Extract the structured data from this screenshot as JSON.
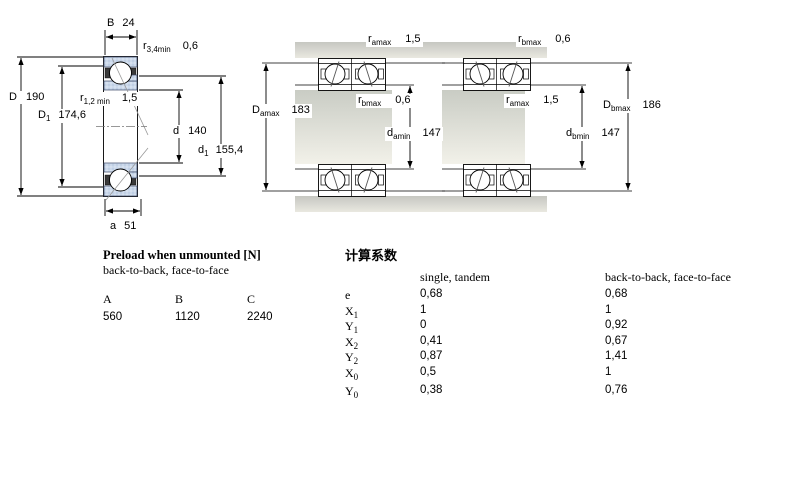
{
  "colors": {
    "ring_fill": "#ccd9eb",
    "ring_dot": "#adc0da",
    "metal_dark": "#c6c7c1",
    "metal_light": "#e9e8e0",
    "line": "#000000"
  },
  "left_view": {
    "dims": {
      "B": {
        "base": "B",
        "sub": "",
        "value": "24"
      },
      "r34": {
        "base": "r",
        "sub": "3,4min",
        "value": "0,6"
      },
      "D": {
        "base": "D",
        "sub": "",
        "value": "190"
      },
      "D1": {
        "base": "D",
        "sub": "1",
        "value": "174,6"
      },
      "r12": {
        "base": "r",
        "sub": "1,2 min",
        "value": "1,5"
      },
      "d": {
        "base": "d",
        "sub": "",
        "value": "140"
      },
      "d1": {
        "base": "d",
        "sub": "1",
        "value": "155,4"
      },
      "a": {
        "base": "a",
        "sub": "",
        "value": "51"
      }
    }
  },
  "pair_views": {
    "left": {
      "r_top": {
        "base": "r",
        "sub": "amax",
        "value": "1,5"
      },
      "r_mid": {
        "base": "r",
        "sub": "bmax",
        "value": "0,6"
      },
      "D_dim": {
        "base": "D",
        "sub": "amax",
        "value": "183"
      },
      "d_dim": {
        "base": "d",
        "sub": "amin",
        "value": "147"
      }
    },
    "right": {
      "r_top": {
        "base": "r",
        "sub": "bmax",
        "value": "0,6"
      },
      "r_mid": {
        "base": "r",
        "sub": "amax",
        "value": "1,5"
      },
      "D_dim": {
        "base": "D",
        "sub": "bmax",
        "value": "186"
      },
      "d_dim": {
        "base": "d",
        "sub": "bmin",
        "value": "147"
      }
    }
  },
  "preload_table": {
    "title": "Preload when unmounted [N]",
    "subtitle": "back-to-back, face-to-face",
    "columns": [
      "A",
      "B",
      "C"
    ],
    "values": [
      "560",
      "1120",
      "2240"
    ]
  },
  "factors_table": {
    "title": "计算系数",
    "col_single": "single, tandem",
    "col_paired": "back-to-back, face-to-face",
    "rows": [
      {
        "base": "e",
        "sub": "",
        "single": "0,68",
        "paired": "0,68"
      },
      {
        "base": "X",
        "sub": "1",
        "single": "1",
        "paired": "1"
      },
      {
        "base": "Y",
        "sub": "1",
        "single": "0",
        "paired": "0,92"
      },
      {
        "base": "X",
        "sub": "2",
        "single": "0,41",
        "paired": "0,67"
      },
      {
        "base": "Y",
        "sub": "2",
        "single": "0,87",
        "paired": "1,41"
      },
      {
        "base": "X",
        "sub": "0",
        "single": "0,5",
        "paired": "1"
      },
      {
        "base": "Y",
        "sub": "0",
        "single": "0,38",
        "paired": "0,76"
      }
    ]
  }
}
